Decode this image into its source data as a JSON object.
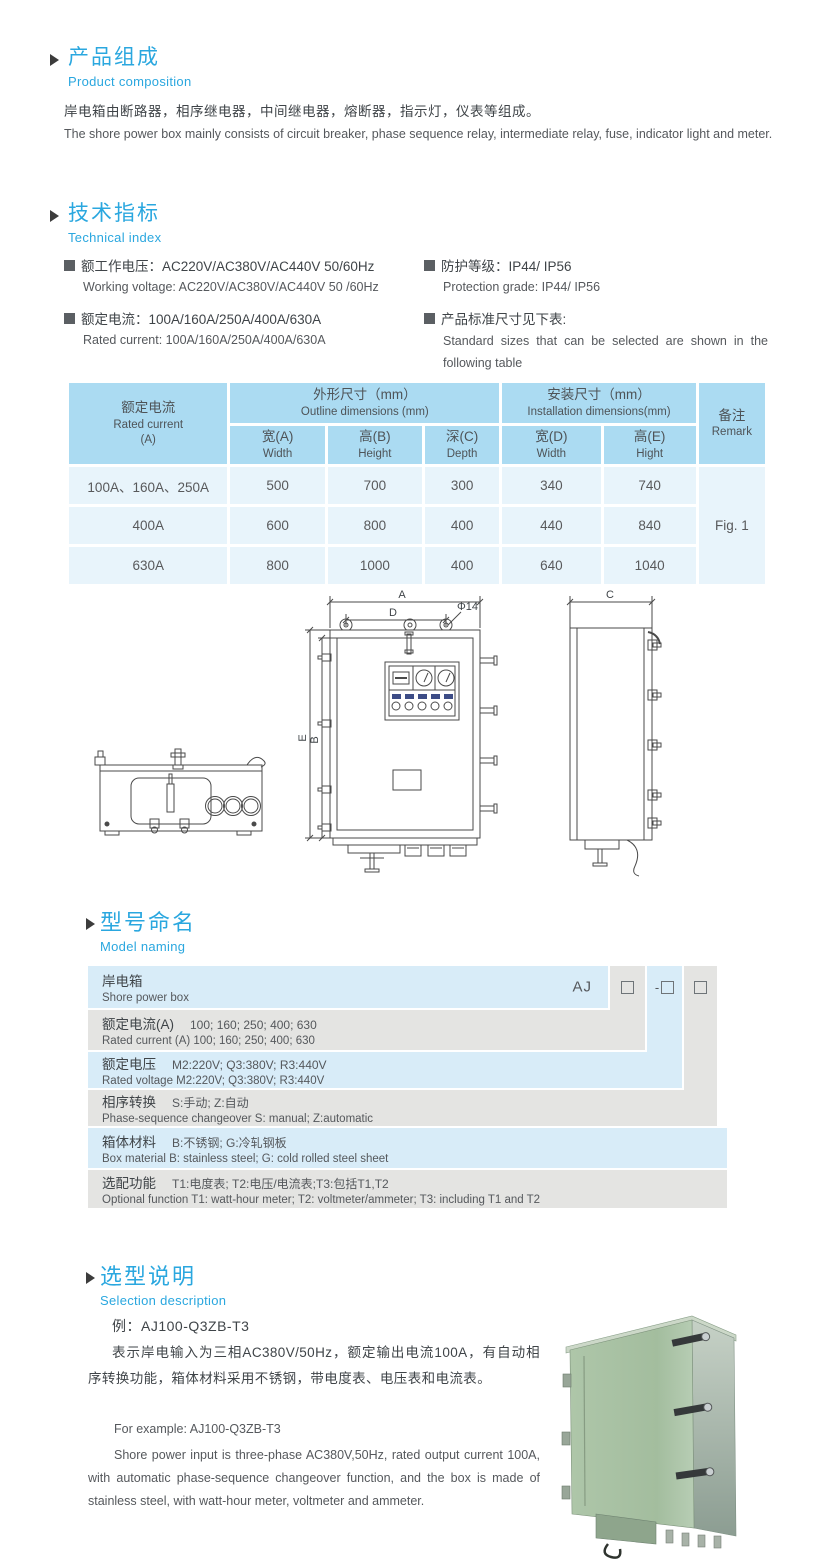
{
  "colors": {
    "accent_blue": "#2AA7DF",
    "table_header_blue": "#ABDBF2",
    "table_row_blue": "#E8F4FB",
    "naming_row_blue": "#D8ECF8",
    "naming_row_gray": "#E4E4E2",
    "box_green": "#A9C2A5"
  },
  "product_composition": {
    "title_cn": "产品组成",
    "title_en": "Product  composition",
    "body_cn": "岸电箱由断路器，相序继电器，中间继电器，熔断器，指示灯，仪表等组成。",
    "body_en": "The shore power box mainly consists of circuit breaker, phase sequence relay, intermediate relay, fuse, indicator light and meter."
  },
  "technical_index": {
    "title_cn": "技术指标",
    "title_en": "Technical index",
    "specs": [
      {
        "cn": "额工作电压：AC220V/AC380V/AC440V  50/60Hz",
        "en": "Working voltage: AC220V/AC380V/AC440V 50 /60Hz"
      },
      {
        "cn": "额定电流：100A/160A/250A/400A/630A",
        "en": "Rated current: 100A/160A/250A/400A/630A"
      },
      {
        "cn": "防护等级：IP44/ IP56",
        "en": "Protection grade: IP44/ IP56"
      },
      {
        "cn": "产品标准尺寸见下表:",
        "en": "Standard sizes that can be selected are shown in the following table"
      }
    ]
  },
  "size_table": {
    "col1": {
      "cn": "额定电流",
      "en": "Rated current",
      "unit": "(A)"
    },
    "group_outline": {
      "cn": "外形尺寸（mm）",
      "en": "Outline dimensions (mm)"
    },
    "group_install": {
      "cn": "安装尺寸（mm）",
      "en": "Installation dimensions(mm)"
    },
    "remark": {
      "cn": "备注",
      "en": "Remark"
    },
    "sub_headers": [
      {
        "cn": "宽(A)",
        "en": "Width"
      },
      {
        "cn": "高(B)",
        "en": "Height"
      },
      {
        "cn": "深(C)",
        "en": "Depth"
      },
      {
        "cn": "宽(D)",
        "en": "Width"
      },
      {
        "cn": "高(E)",
        "en": "Hight"
      }
    ],
    "rows": [
      {
        "current": "100A、160A、250A",
        "w": "500",
        "h": "700",
        "d": "300",
        "iw": "340",
        "ih": "740"
      },
      {
        "current": "400A",
        "w": "600",
        "h": "800",
        "d": "400",
        "iw": "440",
        "ih": "840"
      },
      {
        "current": "630A",
        "w": "800",
        "h": "1000",
        "d": "400",
        "iw": "640",
        "ih": "1040"
      }
    ],
    "remark_value": "Fig. 1"
  },
  "drawing": {
    "dim_a": "A",
    "dim_d": "D",
    "dim_dia": "Φ14",
    "dim_b": "B",
    "dim_e": "E",
    "dim_c": "C"
  },
  "model_naming": {
    "title_cn": "型号命名",
    "title_en": "Model naming",
    "prefix": "AJ",
    "dash": "-",
    "rows": [
      {
        "cn": "岸电箱",
        "en": "Shore power box"
      },
      {
        "label_cn": "额定电流(A)",
        "value_cn": "100; 160; 250; 400; 630",
        "en": "Rated current (A) 100; 160; 250; 400; 630"
      },
      {
        "label_cn": "额定电压",
        "value_cn": "M2:220V;  Q3:380V;  R3:440V",
        "en": "Rated voltage  M2:220V;  Q3:380V;  R3:440V"
      },
      {
        "label_cn": "相序转换",
        "value_cn": "S:手动; Z:自动",
        "en": "Phase-sequence changeover  S: manual;  Z:automatic"
      },
      {
        "label_cn": "箱体材料",
        "value_cn": "B:不锈钢;  G:冷轧钢板",
        "en": "Box material   B: stainless steel; G: cold rolled steel sheet"
      },
      {
        "label_cn": "选配功能",
        "value_cn": "T1:电度表;  T2:电压/电流表;T3:包括T1,T2",
        "en": "Optional function  T1: watt-hour meter; T2: voltmeter/ammeter; T3: including T1 and T2"
      }
    ]
  },
  "selection": {
    "title_cn": "选型说明",
    "title_en": "Selection description",
    "example_cn": "例：AJ100-Q3ZB-T3",
    "body_cn": "表示岸电输入为三相AC380V/50Hz，额定输出电流100A，有自动相序转换功能，箱体材料采用不锈钢，带电度表、电压表和电流表。",
    "example_en": "For example: AJ100-Q3ZB-T3",
    "body_en": "Shore power input is three-phase AC380V,50Hz, rated output current 100A, with automatic phase-sequence changeover function, and the box is made of stainless steel, with watt-hour meter, voltmeter and ammeter."
  }
}
